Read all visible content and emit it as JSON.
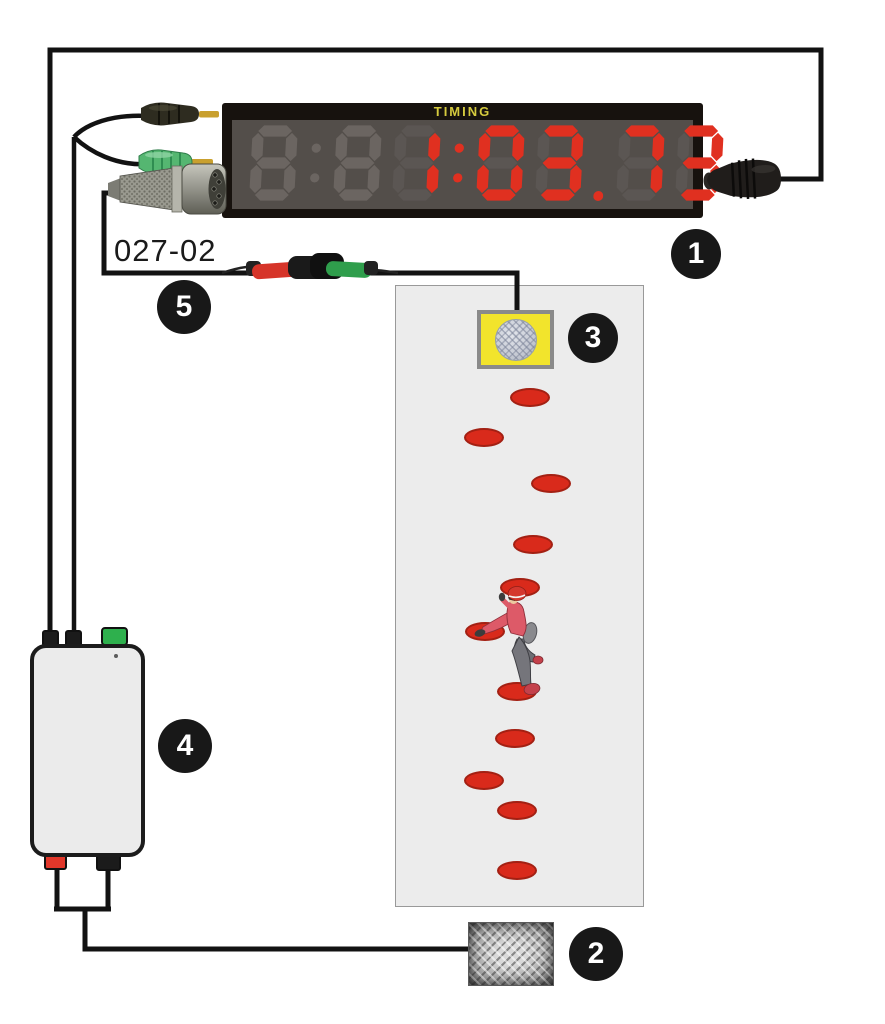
{
  "display": {
    "brand_label": "TIMING",
    "value": "1:03.73",
    "slots": [
      {
        "glyph": "8",
        "lit": false
      },
      {
        "glyph": ":",
        "lit": false
      },
      {
        "glyph": "8",
        "lit": false
      },
      {
        "glyph": "1",
        "lit": true
      },
      {
        "glyph": ":",
        "lit": true
      },
      {
        "glyph": "0",
        "lit": true
      },
      {
        "glyph": "3",
        "lit": true
      },
      {
        "glyph": ".",
        "lit": true
      },
      {
        "glyph": "7",
        "lit": true
      },
      {
        "glyph": "3",
        "lit": true
      }
    ],
    "colors": {
      "frame": "#17120e",
      "background": "#534e4a",
      "lit": "#e03020",
      "dim": "#6b6561",
      "faint": "#5b5653",
      "label": "#d6cb3e"
    }
  },
  "labels": {
    "cable_code": "027-02"
  },
  "callouts": [
    {
      "n": "1"
    },
    {
      "n": "2"
    },
    {
      "n": "3"
    },
    {
      "n": "4"
    },
    {
      "n": "5"
    }
  ],
  "wall": {
    "hold_color": "#d92a1b",
    "hold_border": "#a32013",
    "holds": [
      {
        "x": 530,
        "y": 398
      },
      {
        "x": 484,
        "y": 438
      },
      {
        "x": 551,
        "y": 484
      },
      {
        "x": 533,
        "y": 545
      },
      {
        "x": 520,
        "y": 588
      },
      {
        "x": 485,
        "y": 632
      },
      {
        "x": 517,
        "y": 692
      },
      {
        "x": 515,
        "y": 739
      },
      {
        "x": 484,
        "y": 781
      },
      {
        "x": 517,
        "y": 811
      },
      {
        "x": 517,
        "y": 871
      }
    ]
  },
  "colors": {
    "wire": "#121212",
    "wall_fill": "#ececec",
    "wall_border": "#999999",
    "button_yellow": "#f2e42c",
    "connector_green": "#2eb04d",
    "connector_red": "#e2372a",
    "callout_bg": "#181818",
    "callout_text": "#ffffff",
    "hold": "#d92a1b",
    "hold_border": "#a32013"
  }
}
